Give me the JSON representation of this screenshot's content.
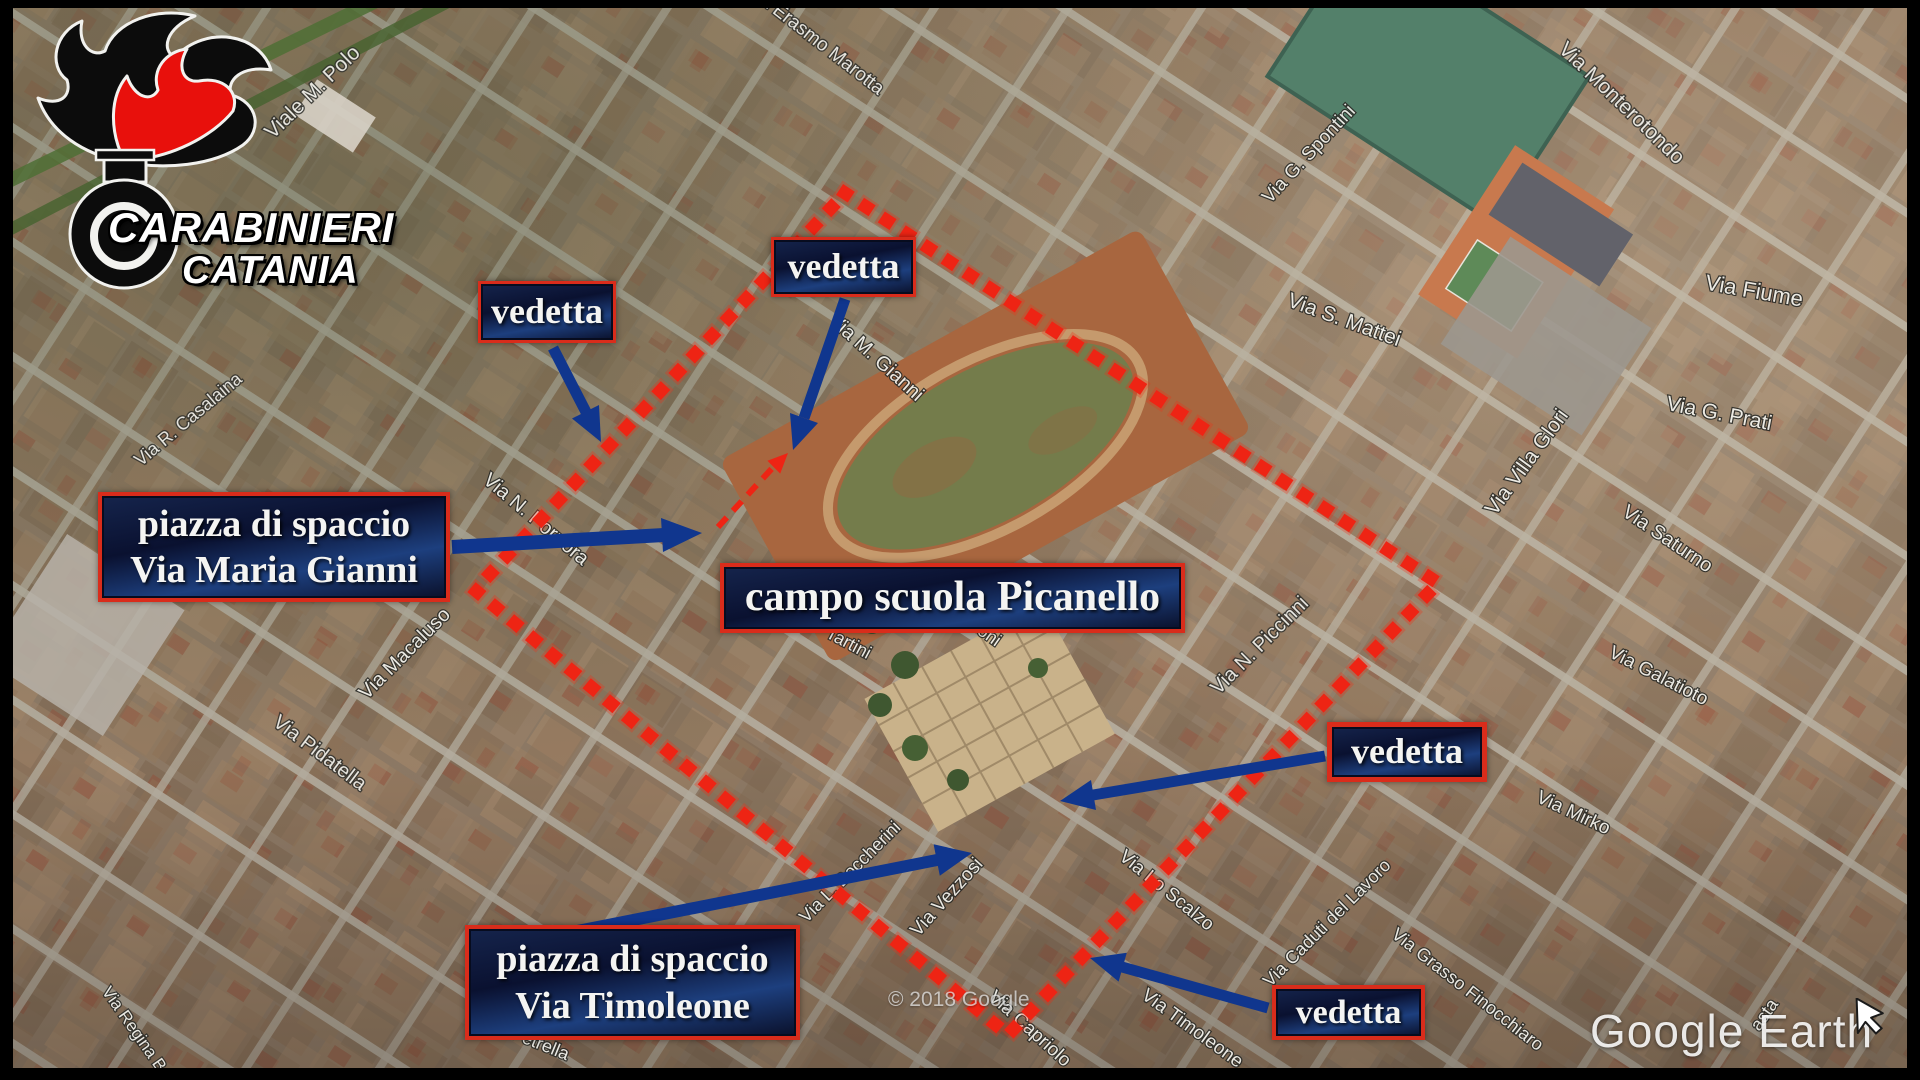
{
  "logo": {
    "line1": "CARABINIERI",
    "line2": "CATANIA",
    "emblem": "carabinieri-flame-grenade"
  },
  "annotations": {
    "lookouts": [
      "vedetta",
      "vedetta",
      "vedetta",
      "vedetta"
    ],
    "dealing_square_gianni": {
      "line1": "piazza di spaccio",
      "line2": "Via Maria Gianni"
    },
    "field_label": "campo scuola Picanello",
    "dealing_square_timoleone": {
      "line1": "piazza di spaccio",
      "line2": "Via Timoleone"
    }
  },
  "watermarks": {
    "copyright": "© 2018 Google",
    "brand": "Google Earth"
  },
  "streets": [
    "Via Erasmo Marotta",
    "Viale M. Polo",
    "Via Monterotondo",
    "Via G. Spontini",
    "Via S. Mattei",
    "Via Fiume",
    "Via G. Prati",
    "Via Villa Glori",
    "Via Saturno",
    "Via Galatioto",
    "Via Mirko",
    "Via M. Gianni",
    "Via R. Casalaina",
    "Via N. Porpora",
    "Via Macaluso",
    "Via Pidatella",
    "Via Regina B.",
    "Tartini",
    "oni",
    "Via N. Piccinni",
    "Via Vezzosi",
    "Via L. Boccherini",
    "Via Lo Scalzo",
    "Via Caduti del Lavoro",
    "Via Grasso Finocchiaro",
    "Via Timoleone",
    "Via Capriolo",
    "Petrella",
    "asta"
  ],
  "colors": {
    "accent_red": "#e8301c",
    "arrow_blue": "#10368e",
    "box_background": "#0b1735",
    "box_border": "#d92c1b"
  }
}
